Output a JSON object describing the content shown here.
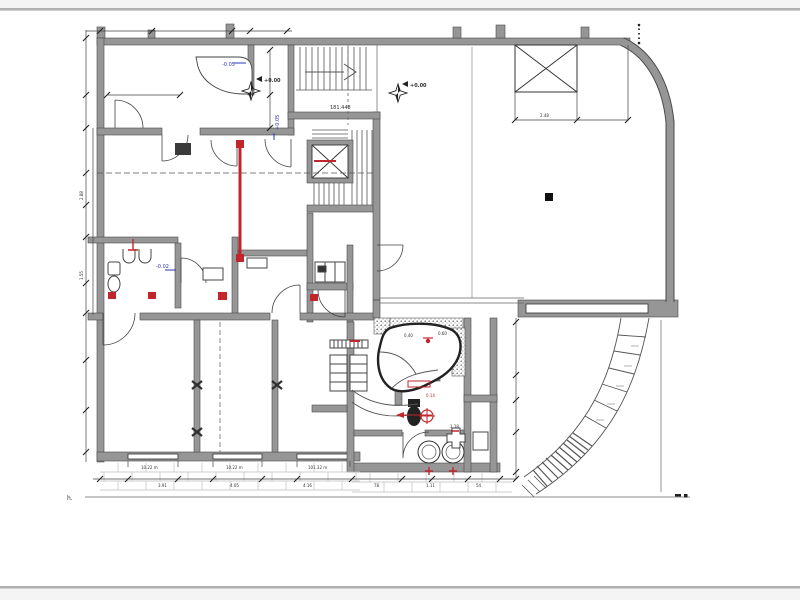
{
  "document": {
    "kind": "architectural-floor-plan",
    "description": "CAD ground-floor plan with stair core, elevator shaft, skylight, pool room, sanitary block and curved exterior ramp"
  },
  "colors": {
    "wall_gray": "#969696",
    "edge_dark": "#4a4a4a",
    "line_dark": "#3c3c3c",
    "page_rule_gray": "#b0b0b0",
    "hatch_light": "#bfbfbf",
    "annotation_red": "#c0262b",
    "annotation_blue": "#2b35b8"
  },
  "icons": {
    "benchmark_star": "survey-benchmark-star",
    "elevator_cross": "shaft-cross",
    "skylight_cross": "roof-opening-cross",
    "column_marker": "wall-joint-x"
  },
  "labels": {
    "bm1": "+0.00",
    "bm2": "+0.00",
    "blue_counter": "-0.05",
    "blue_wall": "+0.05",
    "blue_bath": "-0.02",
    "landing": "181.448",
    "sky_dim": "2.48",
    "win1": "10.22 m",
    "win2": "10.22 m",
    "win3": "101.32 m",
    "dim_b1": "3.91",
    "dim_b2": "4.05",
    "dim_b3": "4.16",
    "dim_bath1": "78",
    "dim_bath2": "1.11",
    "dim_bath3": "54",
    "dim_l1": "2.88",
    "dim_l2": "1.55",
    "pool_d1": "0.40",
    "pool_d2": "0.60",
    "bath_small": "1.18",
    "red_depth": "0.14",
    "terrace": "h."
  }
}
